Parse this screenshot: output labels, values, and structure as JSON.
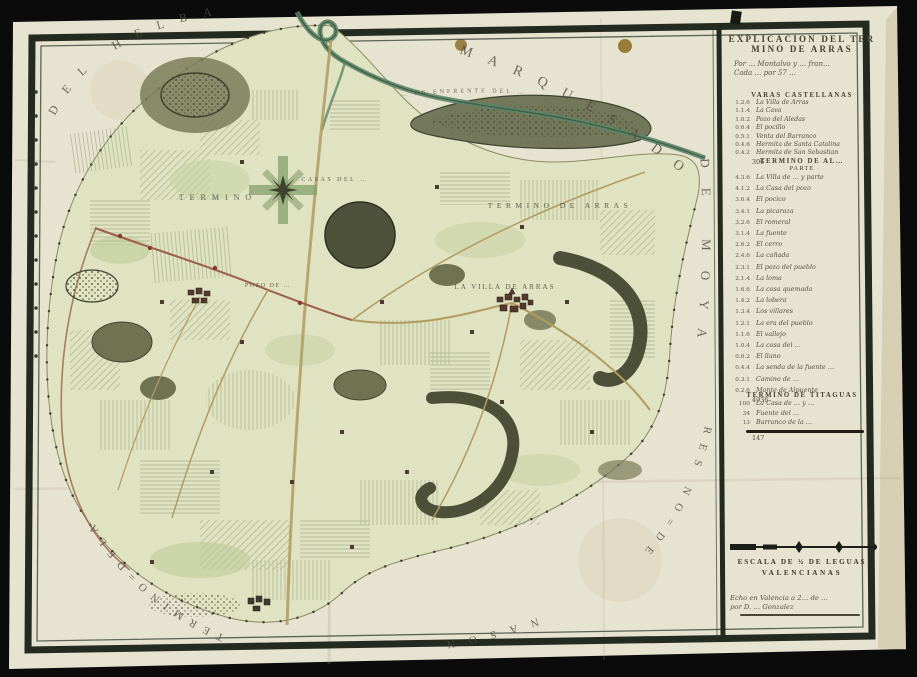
{
  "colors": {
    "photo_background": "#0b0b0b",
    "paper": "#e7e3d1",
    "frame": "#232b21",
    "territory_fill": "#dfe3c2",
    "hill_fill": "#6f7352",
    "river": "#5d8468",
    "road_tan": "#b39a5f",
    "road_red": "#9c5f4a",
    "map_text": "#50493c"
  },
  "map": {
    "arc_labels": {
      "top": "MARQUESADO",
      "top_left": "DEL HELBA",
      "right": "DE MOYA",
      "ridge": "… DE ENFRENTE DEL …",
      "bottom_right": "RES NO=DE",
      "bottom": "NASON",
      "bottom_left": "TERMINO=DELA"
    },
    "place_labels": [
      {
        "text": "TERMINO"
      },
      {
        "text": "CASAS DEL …"
      },
      {
        "text": "TERMINO DE ARRAS"
      },
      {
        "text": "LA VILLA DE ARRAS"
      },
      {
        "text": "POZO DE …"
      }
    ]
  },
  "legend": {
    "title_line1": "EXPLICACION DEL TER",
    "title_line2": "MINO DE ARRAS",
    "hand_note_line1": "Por … Montalvo y … fran…",
    "hand_note_line2": "Cada … por 57 …",
    "section_casas": {
      "header": "VARAS CASTELLANAS",
      "rows": [
        {
          "num": "1.2.6",
          "name": "La Villa de Arras"
        },
        {
          "num": "1.1.4",
          "name": "La Cava"
        },
        {
          "num": "1.0.2",
          "name": "Pozo del Aledas"
        },
        {
          "num": "0.6.4",
          "name": "El pocillo"
        },
        {
          "num": "0.5.1",
          "name": "Venta del Barranco"
        },
        {
          "num": "0.4.6",
          "name": "Hermita de Santa Catalina"
        },
        {
          "num": "0.4.2",
          "name": "Hermita de San Sebastian"
        }
      ],
      "total": "306"
    },
    "section_termino_al": {
      "header": "TERMINO DE AL…",
      "subheader": "PARTE",
      "rows": [
        {
          "num": "4.3.6",
          "name": "La Villa de … y parte"
        },
        {
          "num": "4.1.2",
          "name": "La Casa del pozo"
        },
        {
          "num": "3.6.4",
          "name": "El pocico"
        },
        {
          "num": "3.4.1",
          "name": "La picaraza"
        },
        {
          "num": "3.2.6",
          "name": "El romeral"
        },
        {
          "num": "3.1.4",
          "name": "La fuente"
        },
        {
          "num": "2.6.2",
          "name": "El cerro"
        },
        {
          "num": "2.4.6",
          "name": "La cañada"
        },
        {
          "num": "2.3.1",
          "name": "El pozo del pueblo"
        },
        {
          "num": "2.1.4",
          "name": "La loma"
        },
        {
          "num": "1.6.6",
          "name": "La casa quemada"
        },
        {
          "num": "1.4.2",
          "name": "La lobera"
        },
        {
          "num": "1.3.4",
          "name": "Los villares"
        },
        {
          "num": "1.2.1",
          "name": "La era del pueblo"
        },
        {
          "num": "1.1.6",
          "name": "El vallejo"
        },
        {
          "num": "1.0.4",
          "name": "La casa del …"
        },
        {
          "num": "0.6.2",
          "name": "El llano"
        },
        {
          "num": "0.4.4",
          "name": "La senda de la fuente …"
        },
        {
          "num": "0.3.1",
          "name": "Camino de …"
        },
        {
          "num": "0.2.6",
          "name": "Monte de Alpuente"
        }
      ],
      "total": "4936"
    },
    "section_titaguas": {
      "header": "TERMINO DE TITAGUAS",
      "rows": [
        {
          "num": "100",
          "name": "La Casa de … y …"
        },
        {
          "num": "34",
          "name": "Fuente del …"
        },
        {
          "num": "13",
          "name": "Barranco de la …"
        }
      ],
      "total": "147"
    },
    "scale": {
      "label_line1": "ESCALA DE ¾ DE LEGUAS",
      "label_line2": "VALENCIANAS"
    },
    "signature": {
      "line1": "Echo en Valencia a 2… de …",
      "line2": "por D. … Gonzalez"
    }
  }
}
